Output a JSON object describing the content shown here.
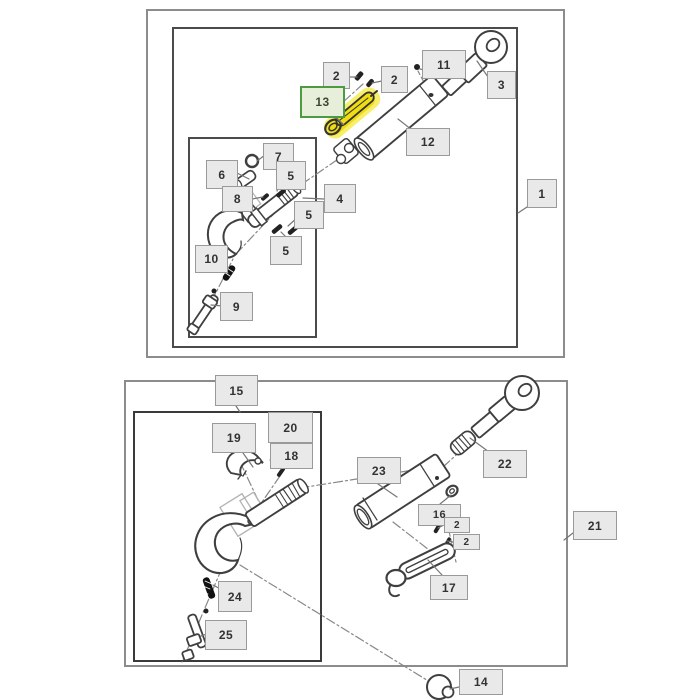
{
  "diagram_title": "top-link-assembly-exploded-parts-diagram",
  "colors": {
    "highlight_fill": "#f0dd11",
    "highlight_soft": "#f6e83c",
    "selected_border": "#4d9b40",
    "selected_fill": "#e7eeda",
    "callout_fill": "#e9e9e9",
    "callout_border": "#9a9a9a",
    "line_art": "#3f3f3f"
  },
  "selected_part": "13",
  "diagram": {
    "top": {
      "assembly_ref": "1",
      "callouts": [
        {
          "part": "2",
          "x": 323,
          "y": 62,
          "w": 27,
          "h": 27
        },
        {
          "part": "2",
          "x": 381,
          "y": 66,
          "w": 27,
          "h": 27
        },
        {
          "part": "11",
          "x": 422,
          "y": 50,
          "w": 44,
          "h": 29
        },
        {
          "part": "3",
          "x": 487,
          "y": 71,
          "w": 29,
          "h": 28
        },
        {
          "part": "13",
          "x": 300,
          "y": 86,
          "w": 45,
          "h": 32,
          "highlighted": true
        },
        {
          "part": "12",
          "x": 406,
          "y": 128,
          "w": 44,
          "h": 28
        },
        {
          "part": "7",
          "x": 263,
          "y": 143,
          "w": 31,
          "h": 27
        },
        {
          "part": "6",
          "x": 206,
          "y": 160,
          "w": 32,
          "h": 29
        },
        {
          "part": "5",
          "x": 276,
          "y": 161,
          "w": 30,
          "h": 29
        },
        {
          "part": "8",
          "x": 222,
          "y": 186,
          "w": 31,
          "h": 26
        },
        {
          "part": "4",
          "x": 324,
          "y": 184,
          "w": 32,
          "h": 29
        },
        {
          "part": "5",
          "x": 294,
          "y": 201,
          "w": 30,
          "h": 28
        },
        {
          "part": "5",
          "x": 270,
          "y": 236,
          "w": 32,
          "h": 29
        },
        {
          "part": "10",
          "x": 195,
          "y": 245,
          "w": 33,
          "h": 28
        },
        {
          "part": "9",
          "x": 220,
          "y": 292,
          "w": 33,
          "h": 29
        },
        {
          "part": "1",
          "x": 527,
          "y": 179,
          "w": 30,
          "h": 29
        }
      ]
    },
    "bottom": {
      "assembly_ref": "21",
      "callouts": [
        {
          "part": "15",
          "x": 215,
          "y": 375,
          "w": 43,
          "h": 31
        },
        {
          "part": "19",
          "x": 212,
          "y": 423,
          "w": 44,
          "h": 30
        },
        {
          "part": "20",
          "x": 268,
          "y": 412,
          "w": 45,
          "h": 31
        },
        {
          "part": "18",
          "x": 270,
          "y": 443,
          "w": 43,
          "h": 26
        },
        {
          "part": "22",
          "x": 483,
          "y": 450,
          "w": 44,
          "h": 28
        },
        {
          "part": "23",
          "x": 357,
          "y": 457,
          "w": 44,
          "h": 27
        },
        {
          "part": "16",
          "x": 418,
          "y": 504,
          "w": 43,
          "h": 22
        },
        {
          "part": "2",
          "x": 444,
          "y": 517,
          "w": 26,
          "h": 16
        },
        {
          "part": "2",
          "x": 453,
          "y": 534,
          "w": 27,
          "h": 16
        },
        {
          "part": "17",
          "x": 430,
          "y": 575,
          "w": 38,
          "h": 25
        },
        {
          "part": "21",
          "x": 573,
          "y": 511,
          "w": 44,
          "h": 29
        },
        {
          "part": "24",
          "x": 218,
          "y": 581,
          "w": 34,
          "h": 31
        },
        {
          "part": "25",
          "x": 205,
          "y": 620,
          "w": 42,
          "h": 30
        },
        {
          "part": "14",
          "x": 459,
          "y": 669,
          "w": 44,
          "h": 26
        }
      ]
    }
  }
}
